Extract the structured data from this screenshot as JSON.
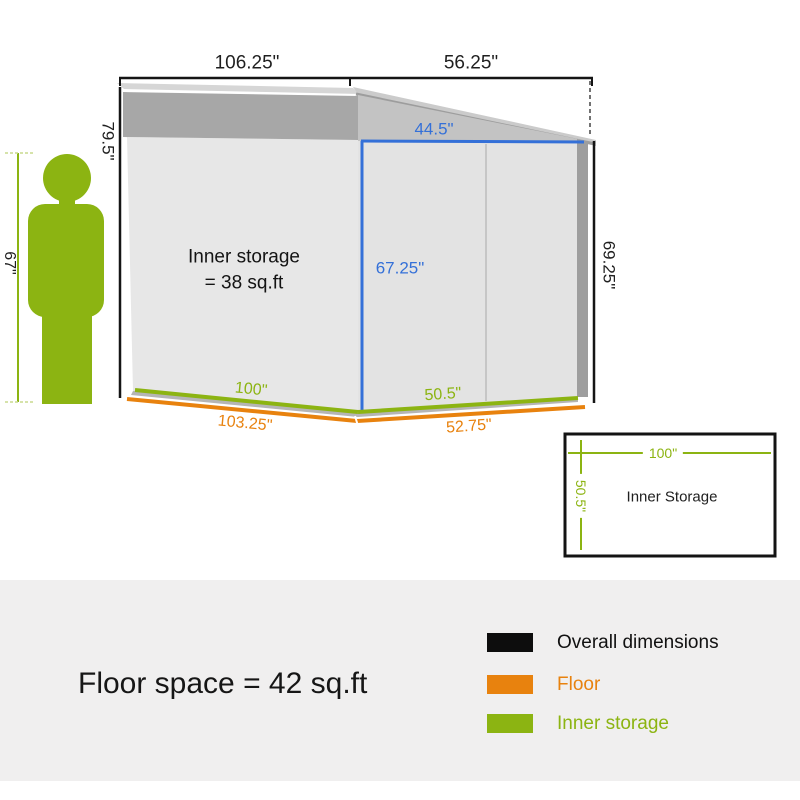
{
  "scale_figure": {
    "height_label": "67\""
  },
  "overall": {
    "width_left": "106.25\"",
    "width_right": "56.25\"",
    "height_left": "79.5\"",
    "height_right": "69.25\""
  },
  "inner": {
    "door_width": "44.5\"",
    "door_height": "67.25\"",
    "floor_width": "100\"",
    "floor_depth": "50.5\"",
    "area_line1": "Inner storage",
    "area_line2": "= 38 sq.ft"
  },
  "floor": {
    "width": "103.25\"",
    "depth": "52.75\""
  },
  "storage_box": {
    "title": "Inner Storage",
    "width": "100\"",
    "depth": "50.5\""
  },
  "footer": {
    "floor_space": "Floor space = 42 sq.ft",
    "legend": [
      {
        "label": "Overall dimensions",
        "color": "#111111"
      },
      {
        "label": "Floor",
        "color": "#e8820e"
      },
      {
        "label": "Inner storage",
        "color": "#8cb412"
      }
    ]
  },
  "colors": {
    "overall_lines": "#111111",
    "floor_lines": "#e8820e",
    "inner_lines": "#8cb412",
    "door_lines": "#3470d8"
  }
}
